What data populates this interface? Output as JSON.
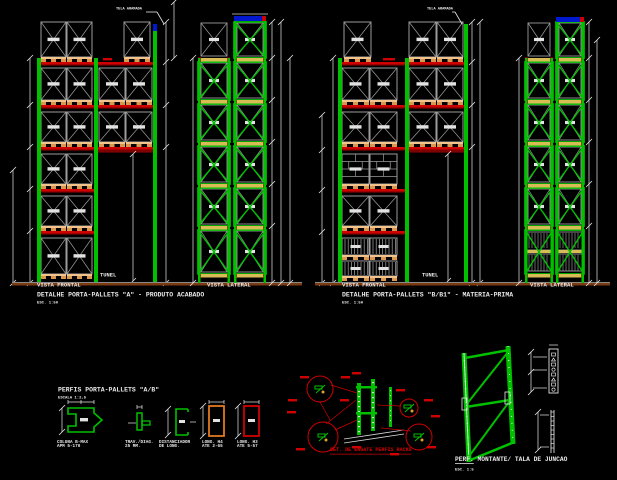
{
  "drawing": {
    "background": "#000000",
    "type_note": "CAD elevation drawing of pallet rack structures"
  },
  "colors": {
    "green": "#00c000",
    "red": "#cf0000",
    "dark_red": "#7e0000",
    "orange": "#e07820",
    "pallet": "#f2c38a",
    "pallet_foot": "#d9974f",
    "lateral_bar": "#d9bb55",
    "gray": "#9c9c9c",
    "light_gray": "#c8c8c8",
    "blue": "#0018d0",
    "white": "#e9e9e9",
    "ground": "#7a3a12"
  },
  "views": {
    "groupA": {
      "frontal_label": "VISTA FRONTAL",
      "lateral_label": "VISTA LATERAL",
      "tunnel_label": "TUNEL",
      "title": "DETALHE PORTA-PALLETS \"A\" - PRODUTO ACABADO",
      "scale": "ESC. 1:50",
      "mesh_note": "TELA ARAMADA"
    },
    "groupB": {
      "frontal_label": "VISTA FRONTAL",
      "lateral_label": "VISTA LATERAL",
      "tunnel_label": "TUNEL",
      "title": "DETALHE PORTA-PALLETS \"B/B1\" - MATERIA-PRIMA",
      "scale": "ESC. 1:50",
      "mesh_note": "TELA ARAMADA"
    }
  },
  "profiles": {
    "title": "PERFIS PORTA-PALLETS \"A/B\"",
    "scale": "ESCALA 1:2,5",
    "items": [
      {
        "label1": "COLUNA B-MAX",
        "label2": "APM 5-170"
      },
      {
        "label1": "TRAV./DIAG.",
        "label2": "25 MM."
      },
      {
        "label1": "DISTANCIADOR",
        "label2": "DE LONG."
      },
      {
        "label1": "LONG. H4",
        "label2": "ATE 2-65"
      },
      {
        "label1": "LONG. H3",
        "label2": "ATE 5-57"
      }
    ]
  },
  "assembly": {
    "caption": "DET. DE ENGATE PERFIS RACKS"
  },
  "montante": {
    "caption_prefix": "PERF.",
    "caption_rest": " MONTANTE/ TALA DE JUNCAO",
    "scale": "ESC. 1:5"
  }
}
